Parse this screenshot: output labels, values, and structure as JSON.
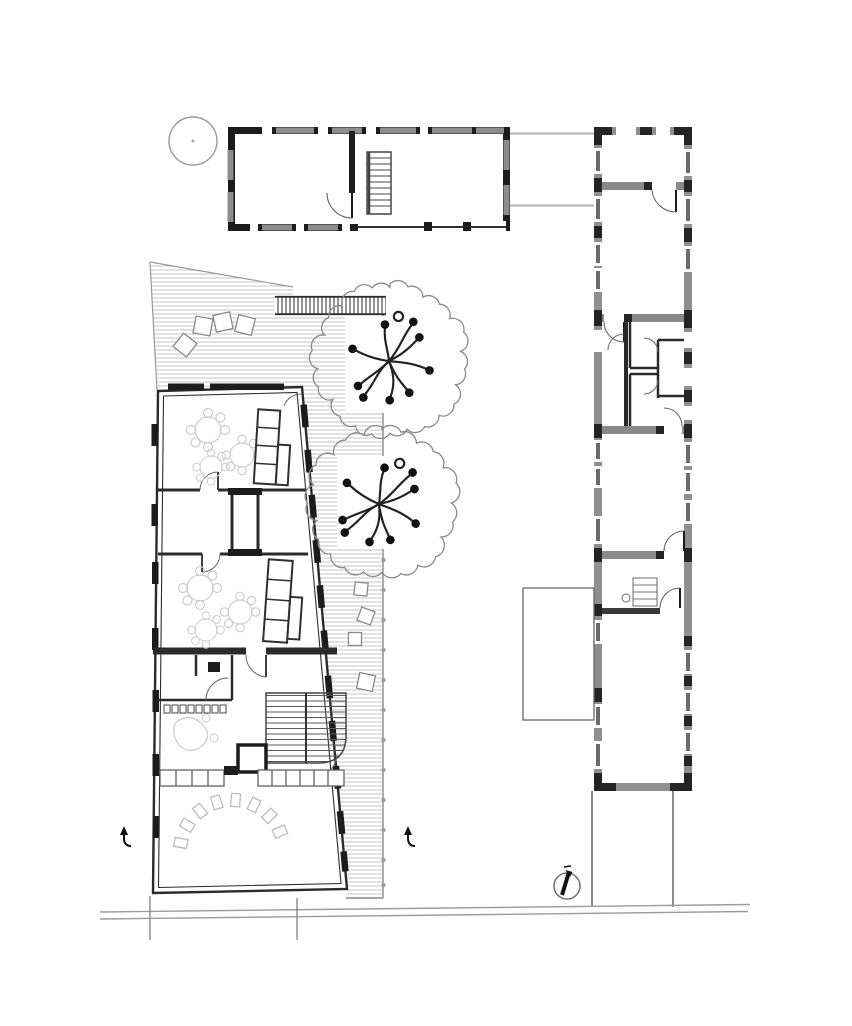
{
  "page": {
    "background": "#ffffff"
  },
  "palette": {
    "paper": "#ffffff",
    "wall_dark": "#1c1c1c",
    "wall_gray": "#8f8f8f",
    "line_medium": "#555555",
    "line_light": "#9a9a9a",
    "deck_hatch": "#c6c6c6",
    "sketch_faint": "#cccccc",
    "glazing": "#6a6a6a"
  },
  "plan": {
    "components": [
      {
        "name": "round-tree-symbol",
        "type": "tree-outline-circle"
      },
      {
        "name": "north-building",
        "type": "building",
        "rooms": 2,
        "features": [
          "ladder",
          "door-swing",
          "window-openings"
        ]
      },
      {
        "name": "east-building",
        "type": "building",
        "features": [
          "poche-walls",
          "door-swings",
          "window-openings",
          "annex-outline",
          "south-court-outline"
        ]
      },
      {
        "name": "main-building",
        "type": "building",
        "features": [
          "slanted-east-wall",
          "group-rooms",
          "benches",
          "stair",
          "elevator",
          "chair-arc",
          "shelving"
        ]
      },
      {
        "name": "deck-terrace",
        "type": "hatched-deck",
        "features": [
          "stepping-squares",
          "tree-cutouts",
          "edge-dots"
        ]
      },
      {
        "name": "boardwalk",
        "type": "slatted-walkway"
      },
      {
        "name": "tree-1",
        "type": "canopy-with-branch-symbol"
      },
      {
        "name": "tree-2",
        "type": "canopy-with-branch-symbol"
      },
      {
        "name": "north-indicator",
        "type": "compass-icon"
      },
      {
        "name": "entrance-arrow-west",
        "type": "arrow-icon"
      },
      {
        "name": "entrance-arrow-court",
        "type": "arrow-icon"
      },
      {
        "name": "road-edge-lines",
        "type": "site-boundary"
      }
    ]
  }
}
